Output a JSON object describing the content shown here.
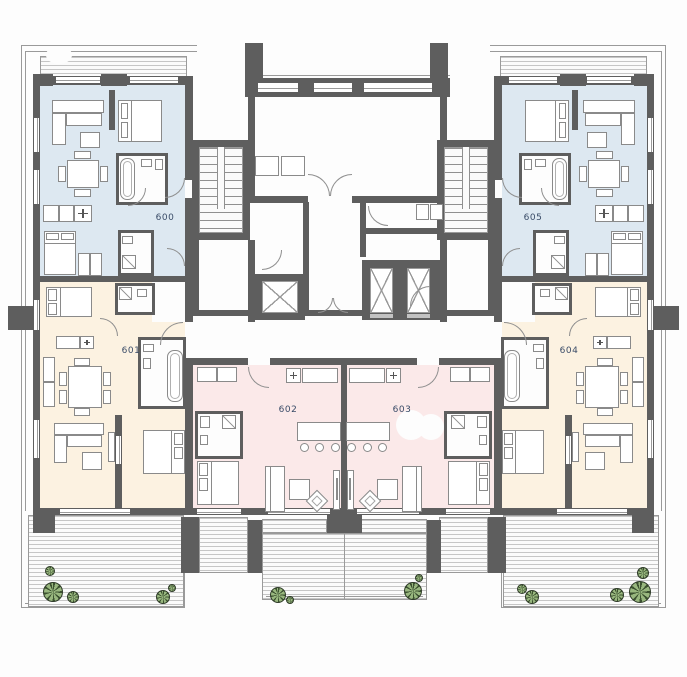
{
  "plan_title": "residential floor plan - level 6",
  "units": [
    {
      "id": "unit-600",
      "label": "600",
      "color_key": "blue"
    },
    {
      "id": "unit-601",
      "label": "601",
      "color_key": "cream"
    },
    {
      "id": "unit-602",
      "label": "602",
      "color_key": "pink"
    },
    {
      "id": "unit-603",
      "label": "603",
      "color_key": "pink"
    },
    {
      "id": "unit-604",
      "label": "604",
      "color_key": "cream"
    },
    {
      "id": "unit-605",
      "label": "605",
      "color_key": "blue"
    }
  ],
  "colors": {
    "blue": "#dde8f1",
    "cream": "#fcf2e1",
    "pink": "#fbe9e9",
    "wall": "#5e5e5e",
    "thin_line": "#9a9a9a",
    "label_text": "#3a4c68",
    "tree_fill": "#86aa68",
    "tree_stroke": "#2e3b28"
  },
  "trees": [
    {
      "x": 53,
      "y": 592,
      "r": 10
    },
    {
      "x": 50,
      "y": 571,
      "r": 5
    },
    {
      "x": 73,
      "y": 597,
      "r": 6
    },
    {
      "x": 163,
      "y": 597,
      "r": 7
    },
    {
      "x": 172,
      "y": 588,
      "r": 4
    },
    {
      "x": 278,
      "y": 595,
      "r": 8
    },
    {
      "x": 290,
      "y": 600,
      "r": 4
    },
    {
      "x": 413,
      "y": 591,
      "r": 9
    },
    {
      "x": 419,
      "y": 578,
      "r": 4
    },
    {
      "x": 522,
      "y": 589,
      "r": 5
    },
    {
      "x": 532,
      "y": 597,
      "r": 7
    },
    {
      "x": 617,
      "y": 595,
      "r": 7
    },
    {
      "x": 640,
      "y": 592,
      "r": 11
    },
    {
      "x": 643,
      "y": 573,
      "r": 6
    }
  ]
}
